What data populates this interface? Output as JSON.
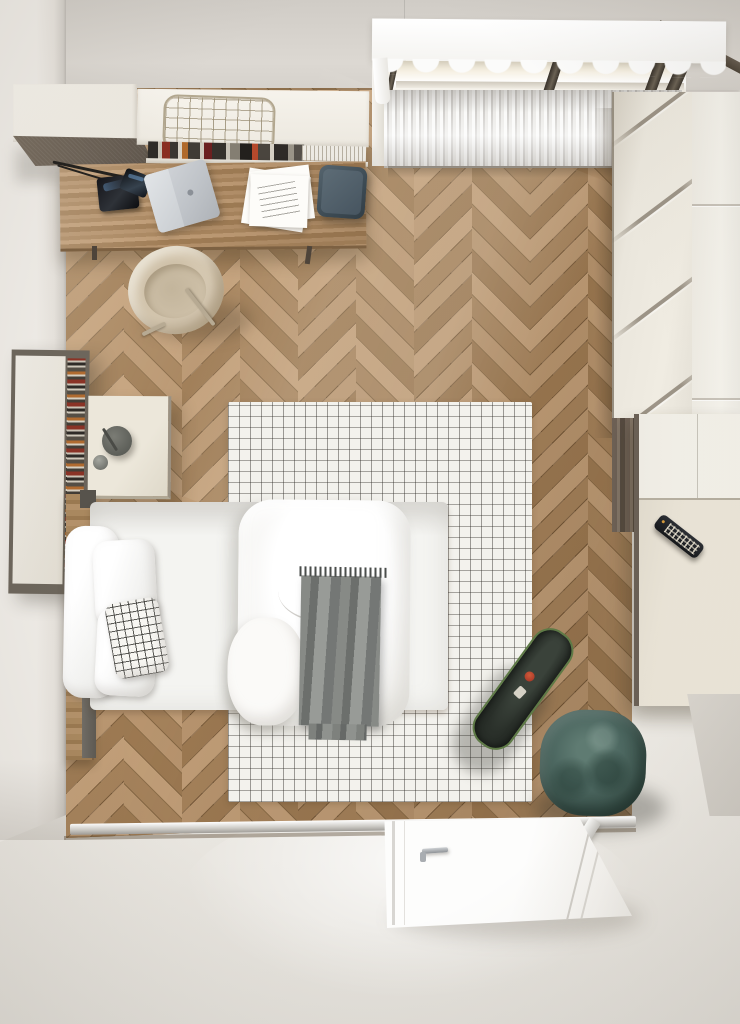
{
  "image": {
    "type": "3d-render-interior",
    "view": "top-down bird's eye",
    "subject": "small bedroom with desk corner, single bed, wardrobe, radiator window and open door"
  },
  "palette": {
    "wall_top": "#d8d4ce",
    "wall_left": "#ece9e4",
    "floor_wood_light": "#c19e78",
    "floor_wood_mid": "#ab885f",
    "floor_wood_dark": "#9c7952",
    "outside_floor": "#efede8",
    "rug_base": "#f3f2ed",
    "rug_grid": "#3a3733",
    "bedding_white": "#ffffff",
    "throw_gray": "#787b78",
    "pouf_teal": "#46615a",
    "stool_slate": "#46545e",
    "wardrobe_cream": "#eeeae0",
    "cabinet_front_taupe": "#6f655a",
    "desk_wood": "#ad8a60",
    "chair_beige": "#d2c4ac",
    "skateboard_deck": "#2b312b",
    "skateboard_rim": "#5e7a46",
    "radiator_white": "#ecebe8",
    "window_frame": "#4c4337",
    "remote_black": "#1d2024"
  },
  "objects": [
    {
      "name": "wall-cabinet",
      "description": "wall-hung cabinet with taupe front and wire basket on top",
      "color": "#f0ede6"
    },
    {
      "name": "book-row",
      "description": "row of books on open shelf under cabinet",
      "color": "mixed"
    },
    {
      "name": "desk",
      "description": "wooden desk with black lamp, silver laptop, papers and slate fabric stool",
      "color": "#ad8a60"
    },
    {
      "name": "desk-chair",
      "description": "beige shell chair partly under desk",
      "color": "#d2c4ac"
    },
    {
      "name": "window",
      "description": "slanted roof window with sheer valance curtain",
      "color": "#f5efe1"
    },
    {
      "name": "radiator",
      "description": "white ribbed panel radiator under window",
      "color": "#ecebe8"
    },
    {
      "name": "wardrobe",
      "description": "tall cream wardrobe with diagonal grooves, right wall",
      "color": "#eeeae0"
    },
    {
      "name": "lower-cabinet",
      "description": "cream low cabinet with black TV remote on top",
      "color": "#e9e3d6"
    },
    {
      "name": "bookshelf",
      "description": "narrow wall shelf with stacked magazines, left wall",
      "color": "#6d665c"
    },
    {
      "name": "nightstand",
      "description": "cream bedside table with round gray lamp",
      "color": "#e7e1d3"
    },
    {
      "name": "bed",
      "description": "single bed, white pillows, checkered cushion, white duvet, gray fringed throw",
      "color": "#ffffff"
    },
    {
      "name": "rug",
      "description": "white grid-pattern area rug",
      "color": "#f3f2ed"
    },
    {
      "name": "skateboard",
      "description": "dark deck skateboard with red/white graphic on rug edge",
      "color": "#2b312b"
    },
    {
      "name": "pouf",
      "description": "rounded square teal velvet pouf",
      "color": "#46615a"
    },
    {
      "name": "door",
      "description": "white door lying open at bottom with chrome lever handle",
      "color": "#fdfdfc"
    },
    {
      "name": "threshold",
      "description": "metal threshold strip at room entrance",
      "color": "#cbc9c4"
    }
  ]
}
